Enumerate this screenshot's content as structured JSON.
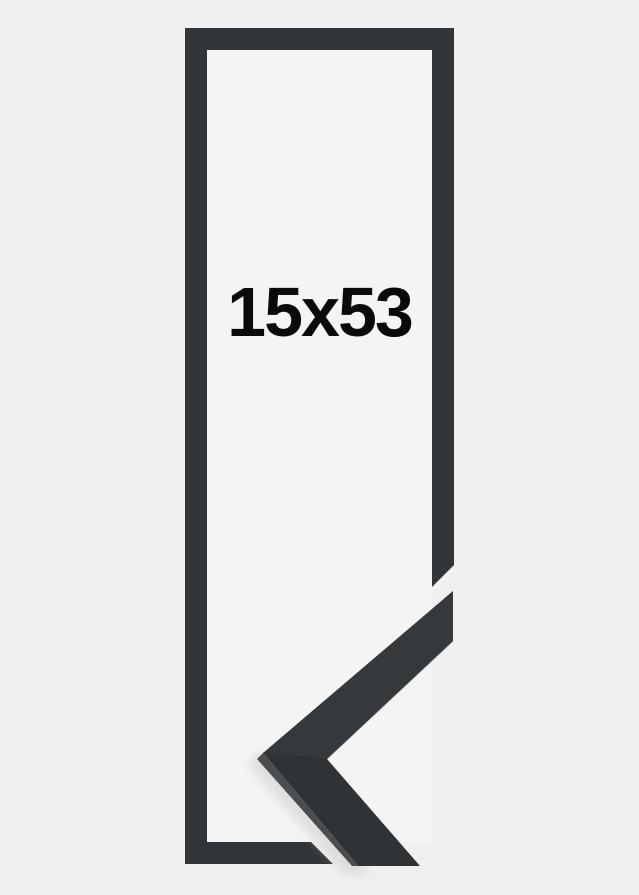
{
  "label": {
    "size": "15x53"
  },
  "colors": {
    "background": "#f0f0f1",
    "frame_opening": "#f4f4f5",
    "frame_outline": "#323537",
    "corner_face_upper": "#36393b",
    "corner_face_lower": "#303335",
    "corner_side": "#4b4e50",
    "corner_edge_highlight": "#565a5c",
    "corner_seam": "#1f2223",
    "shadow": "#c4c4c4",
    "label_text": "#0a0a0a"
  }
}
